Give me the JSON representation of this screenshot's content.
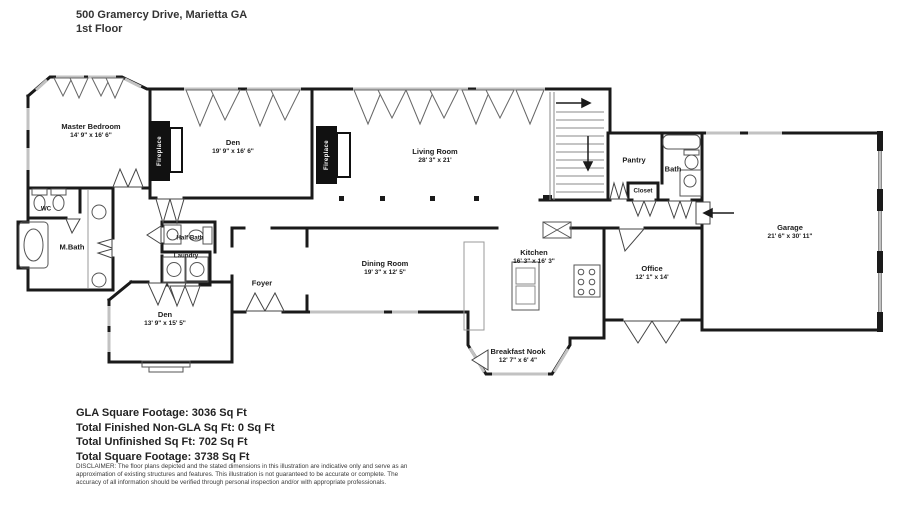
{
  "header": {
    "address": "500 Gramercy Drive, Marietta GA",
    "floor": "1st Floor"
  },
  "rooms": {
    "master_bedroom": {
      "name": "Master Bedroom",
      "dims": "14' 9\" x 16' 6\""
    },
    "den_upper": {
      "name": "Den",
      "dims": "19' 9\" x 16' 6\""
    },
    "living_room": {
      "name": "Living Room",
      "dims": "28' 3\" x 21'"
    },
    "pantry": {
      "name": "Pantry"
    },
    "bath": {
      "name": "Bath"
    },
    "closet": {
      "name": "Closet"
    },
    "garage": {
      "name": "Garage",
      "dims": "21' 6\" x 30' 11\""
    },
    "wc": {
      "name": "WC"
    },
    "master_bath": {
      "name": "M.Bath"
    },
    "half_bath": {
      "name": "Half Bath"
    },
    "laundry": {
      "name": "Laundry"
    },
    "foyer": {
      "name": "Foyer"
    },
    "dining_room": {
      "name": "Dining Room",
      "dims": "19' 3\" x 12' 5\""
    },
    "den_lower": {
      "name": "Den",
      "dims": "13' 9\" x 15' 5\""
    },
    "kitchen": {
      "name": "Kitchen",
      "dims": "16' 3\" x 16' 3\""
    },
    "office": {
      "name": "Office",
      "dims": "12' 1\" x 14'"
    },
    "breakfast_nook": {
      "name": "Breakfast Nook",
      "dims": "12' 7\" x 6' 4\""
    },
    "fireplace": {
      "name": "Fireplace"
    }
  },
  "summary": {
    "lines": [
      "GLA Square Footage: 3036 Sq Ft",
      "Total Finished Non-GLA Sq Ft: 0 Sq Ft",
      "Total Unfinished Sq Ft: 702 Sq Ft",
      "Total Square Footage: 3738 Sq Ft"
    ]
  },
  "disclaimer": {
    "text": "DISCLAIMER: The floor plans depicted and the stated dimensions in this illustration are indicative only and serve as an approximation of existing structures and features. This illustration is not guaranteed to be accurate or complete. The accuracy of all information should be verified through personal inspection and/or with appropriate professionals."
  },
  "colors": {
    "wall": "#1a1a1a",
    "window": "#c2c2c2",
    "fixture": "#555555"
  }
}
